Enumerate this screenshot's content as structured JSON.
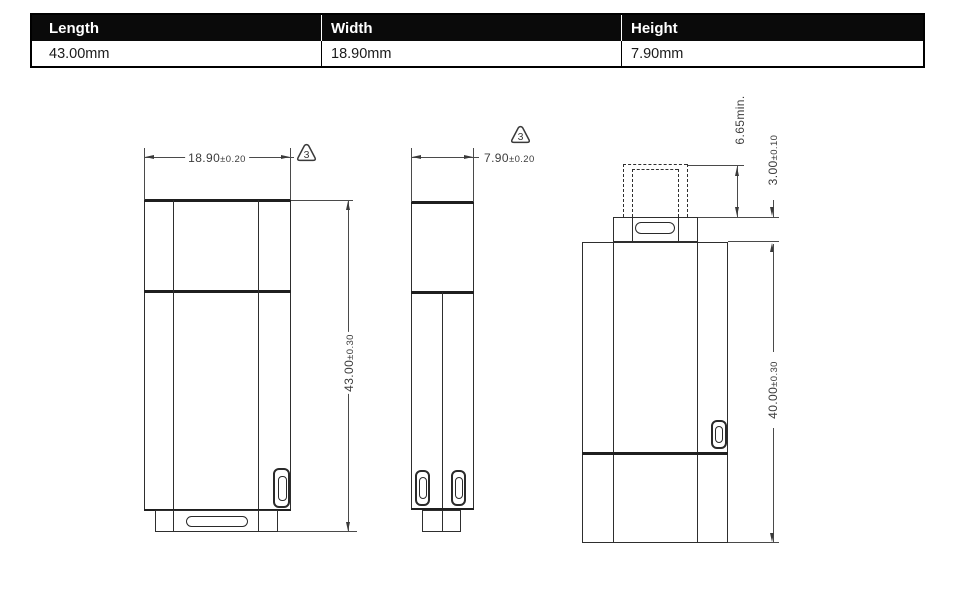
{
  "spec_table": {
    "headers": [
      "Length",
      "Width",
      "Height"
    ],
    "values": [
      "43.00mm",
      "18.90mm",
      "7.90mm"
    ]
  },
  "front_view": {
    "width_value": "18.90",
    "width_tol": "±0.20",
    "length_value": "43.00",
    "length_tol": "±0.30",
    "revision_mark": "3"
  },
  "side_view": {
    "thickness_value": "7.90",
    "thickness_tol": "±0.20",
    "revision_mark": "3"
  },
  "rear_view": {
    "connector_height": "6.65min.",
    "collar_value": "3.00",
    "collar_tol": "±0.10",
    "body_value": "40.00",
    "body_tol": "±0.30"
  }
}
